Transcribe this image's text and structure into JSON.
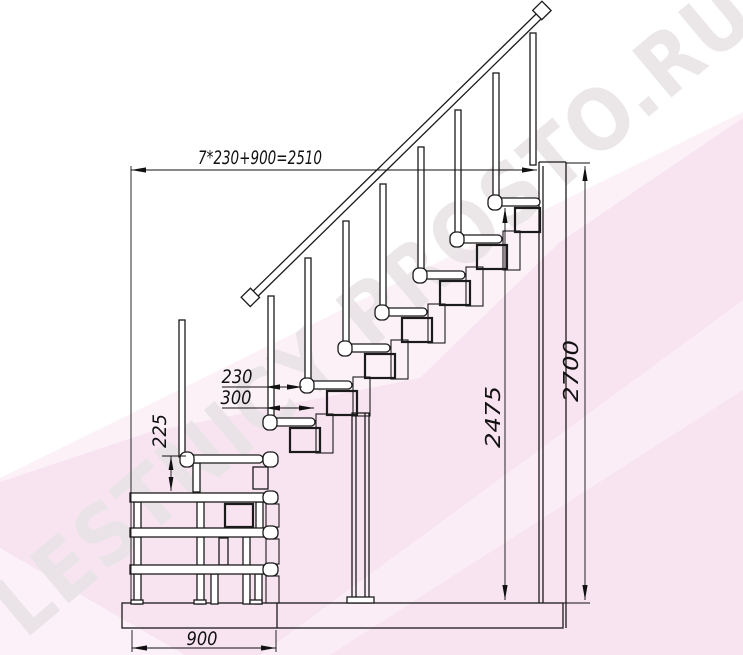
{
  "watermark": {
    "text": "LESTNICY PROSTO.RU"
  },
  "dimensions": {
    "total_run_formula": "7*230+900=2510",
    "overall_height": "2700",
    "height_to_top_tread": "2475",
    "step_run": "230",
    "tread_depth": "300",
    "first_step_rise": "225",
    "platform_depth": "900"
  },
  "colors": {
    "line": "#1b1b1b",
    "background": "#ffffff",
    "pink_band": "#f8e3f0",
    "pink_band_light": "#fdf1f8",
    "watermark_gray": "#b9aab3"
  }
}
